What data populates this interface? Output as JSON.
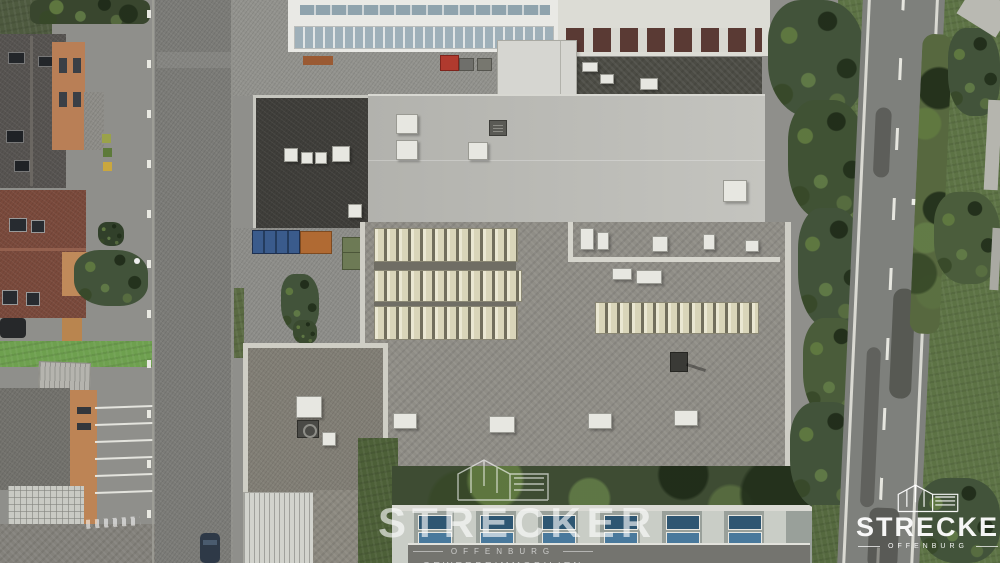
{
  "scene_description": "Aerial drone photograph (top-down) of a commercial/industrial building complex: large flat gravel roofs with rows of cream sawtooth skylights, a light-gray hall roof, dark flat roof annex, surrounding streets, parking bays, residential houses with red tiled roofs at left, a tree-lined bypass road at right, and a blue-skylight hall at bottom",
  "watermark": {
    "title": "STRECKER",
    "subtitle": "OFFENBURG",
    "tagline": "GEWERBEIMMOBILIEN"
  },
  "corner_logo": {
    "title": "STRECKER",
    "subtitle": "OFFENBURG"
  },
  "palette": {
    "hall_roof_light": "#bcbcb7",
    "gravel_roof": "#908e87",
    "dark_roof": "#3f3e3a",
    "skylight_cream": "#ddd9bf",
    "asphalt": "#7c7c78",
    "grass": "#5d7345",
    "tree_green": "#44552f",
    "tile_red": "#7a4a3c",
    "terrace_orange": "#c08a5a",
    "window_blue": "#3d6e96",
    "watermark_white": "#ffffff"
  }
}
